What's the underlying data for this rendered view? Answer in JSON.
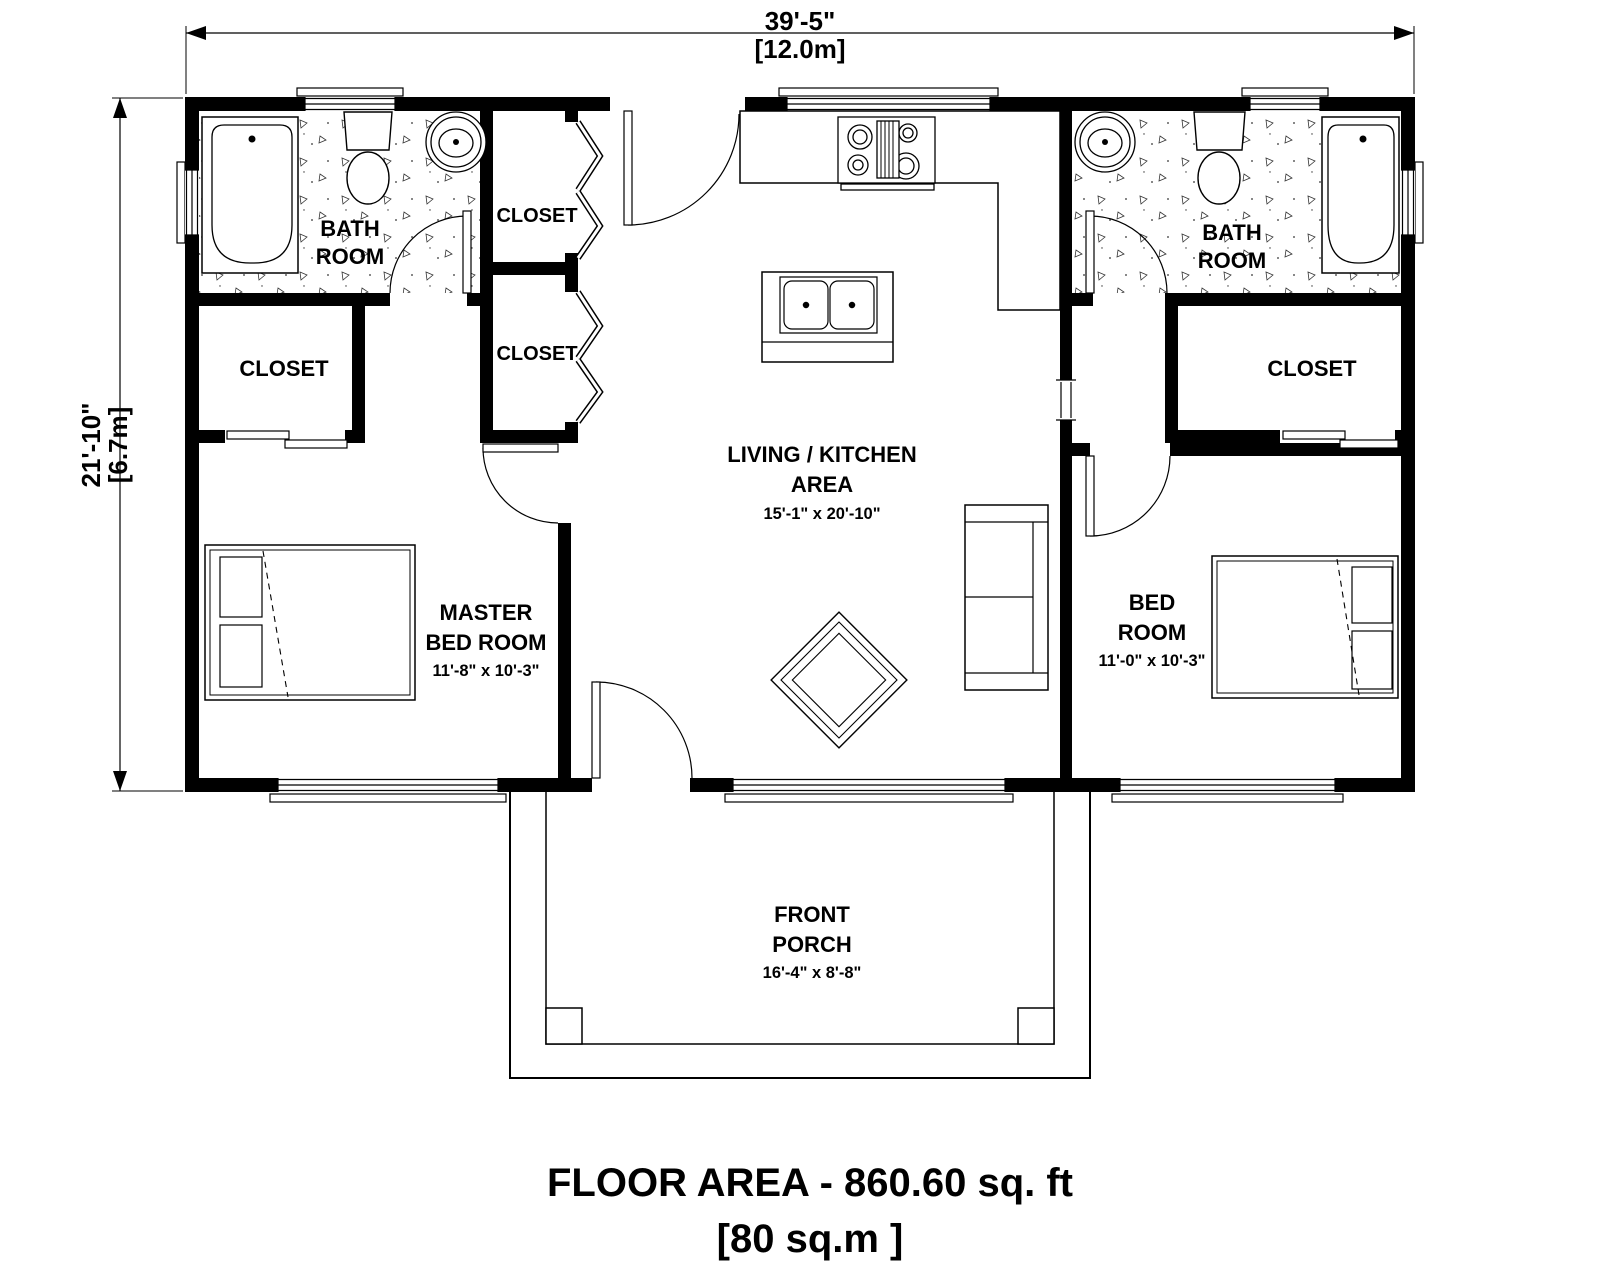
{
  "sheet": {
    "floor_area_title": "FLOOR AREA - 860.60 sq. ft",
    "floor_area_metric": "[80 sq.m ]"
  },
  "dimensions": {
    "width_imperial": "39'-5\"",
    "width_metric": "[12.0m]",
    "height_imperial": "21'-10\"",
    "height_metric": "[6.7m]"
  },
  "rooms": {
    "bath_left": {
      "line1": "BATH",
      "line2": "ROOM"
    },
    "bath_right": {
      "line1": "BATH",
      "line2": "ROOM"
    },
    "closet_left": {
      "label": "CLOSET"
    },
    "closet_center_top": {
      "label": "CLOSET"
    },
    "closet_center_bottom": {
      "label": "CLOSET"
    },
    "closet_right": {
      "label": "CLOSET"
    },
    "living": {
      "line1": "LIVING / KITCHEN",
      "line2": "AREA",
      "size": "15'-1\" x 20'-10\""
    },
    "master_bedroom": {
      "line1": "MASTER",
      "line2": "BED ROOM",
      "size": "11'-8\" x 10'-3\""
    },
    "bedroom": {
      "line1": "BED",
      "line2": "ROOM",
      "size": "11'-0\" x 10'-3\""
    },
    "front_porch": {
      "line1": "FRONT",
      "line2": "PORCH",
      "size": "16'-4\" x 8'-8\""
    }
  },
  "colors": {
    "wall": "#000000",
    "line": "#000000",
    "background": "#ffffff"
  }
}
